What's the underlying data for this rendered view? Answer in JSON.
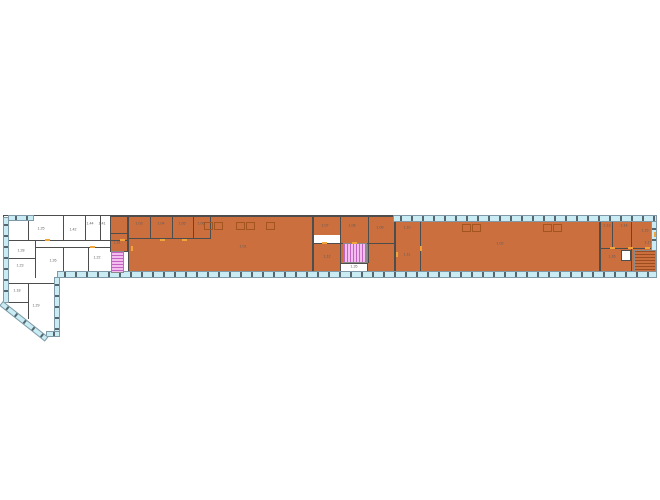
{
  "page": {
    "title": ""
  },
  "plan": {
    "colors": {
      "floor_white": "#ffffff",
      "highlight_orange": "#cb6f3e",
      "wall": "#4d4d4d",
      "outline": "#7e8487",
      "glass": "#c9ecf4",
      "glassEdge": "#7f9aa6",
      "mullion": "#55666d",
      "door": "#f0a43a",
      "desk": "#a3541f",
      "stair_pink": "#f3bdf0",
      "stair_pink_tread": "#c263c2",
      "stair_orange_tread": "#9d4c1d",
      "stairEdge": "#8b8b8b",
      "label": "#5c5c5c"
    },
    "shapes": [
      {
        "name": "building-main-strip",
        "x": 3,
        "y": 215,
        "w": 654,
        "h": 63,
        "fill": "#ffffff",
        "stroke": "#7e8487"
      },
      {
        "name": "building-left-wing",
        "x": 3,
        "y": 215,
        "w": 57,
        "h": 121,
        "fill": "#ffffff"
      },
      {
        "name": "diagonal-mask",
        "x": 1,
        "y": 302,
        "w": 72,
        "h": 48,
        "fill": "#ffffff",
        "rot": 38.3
      },
      {
        "name": "service-rooms-west",
        "x": 110,
        "y": 216,
        "w": 18,
        "h": 36,
        "fill": "#cb6f3e",
        "stroke": "#4d4d4d"
      },
      {
        "name": "open-office-west",
        "x": 128,
        "y": 216,
        "w": 185,
        "h": 57,
        "fill": "#cb6f3e",
        "stroke": "#4d4d4d"
      },
      {
        "name": "core-cluster",
        "x": 313,
        "y": 216,
        "w": 82,
        "h": 57,
        "fill": "#cb6f3e",
        "stroke": "#4d4d4d"
      },
      {
        "name": "open-office-east",
        "x": 395,
        "y": 221,
        "w": 205,
        "h": 51,
        "fill": "#cb6f3e",
        "stroke": "#4d4d4d"
      },
      {
        "name": "east-rooms",
        "x": 600,
        "y": 221,
        "w": 57,
        "h": 51,
        "fill": "#cb6f3e",
        "stroke": "#4d4d4d"
      },
      {
        "name": "corridor-notch",
        "x": 314,
        "y": 235,
        "w": 26,
        "h": 8,
        "fill": "#ffffff"
      },
      {
        "name": "stair-landing",
        "x": 340,
        "y": 263,
        "w": 28,
        "h": 10,
        "fill": "#ffffff",
        "stroke": "#4d4d4d"
      },
      {
        "name": "elevator",
        "x": 621,
        "y": 250,
        "w": 10,
        "h": 11,
        "fill": "#ffffff",
        "stroke": "#4d4d4d"
      }
    ],
    "walls": [
      {
        "x": 3,
        "y": 215,
        "w": 392,
        "h": 1
      },
      {
        "x": 3,
        "y": 215,
        "w": 1,
        "h": 88
      },
      {
        "x": 28,
        "y": 215,
        "w": 1,
        "h": 26
      },
      {
        "x": 63,
        "y": 215,
        "w": 1,
        "h": 26
      },
      {
        "x": 85,
        "y": 215,
        "w": 1,
        "h": 26
      },
      {
        "x": 100,
        "y": 215,
        "w": 1,
        "h": 26
      },
      {
        "x": 8,
        "y": 240,
        "w": 120,
        "h": 1
      },
      {
        "x": 35,
        "y": 240,
        "w": 1,
        "h": 38
      },
      {
        "x": 3,
        "y": 258,
        "w": 33,
        "h": 1
      },
      {
        "x": 35,
        "y": 247,
        "w": 75,
        "h": 1
      },
      {
        "x": 63,
        "y": 247,
        "w": 1,
        "h": 31
      },
      {
        "x": 88,
        "y": 247,
        "w": 1,
        "h": 31
      },
      {
        "x": 3,
        "y": 283,
        "w": 56,
        "h": 1
      },
      {
        "x": 28,
        "y": 283,
        "w": 1,
        "h": 36
      },
      {
        "x": 3,
        "y": 302,
        "w": 26,
        "h": 1
      },
      {
        "x": 150,
        "y": 216,
        "w": 1,
        "h": 23
      },
      {
        "x": 172,
        "y": 216,
        "w": 1,
        "h": 23
      },
      {
        "x": 193,
        "y": 216,
        "w": 1,
        "h": 23
      },
      {
        "x": 210,
        "y": 216,
        "w": 1,
        "h": 23
      },
      {
        "x": 128,
        "y": 238,
        "w": 83,
        "h": 1
      },
      {
        "x": 110,
        "y": 233,
        "w": 18,
        "h": 1
      },
      {
        "x": 340,
        "y": 216,
        "w": 1,
        "h": 57
      },
      {
        "x": 368,
        "y": 216,
        "w": 1,
        "h": 47
      },
      {
        "x": 313,
        "y": 243,
        "w": 82,
        "h": 1
      },
      {
        "x": 420,
        "y": 221,
        "w": 1,
        "h": 51
      },
      {
        "x": 612,
        "y": 221,
        "w": 1,
        "h": 28
      },
      {
        "x": 631,
        "y": 221,
        "w": 1,
        "h": 28
      },
      {
        "x": 600,
        "y": 248,
        "w": 57,
        "h": 1
      },
      {
        "x": 631,
        "y": 248,
        "w": 1,
        "h": 24
      }
    ],
    "windows": [
      {
        "name": "window-band-top",
        "x": 393,
        "y": 215,
        "w": 264,
        "h": 7,
        "dir": "h"
      },
      {
        "name": "window-band-bottom",
        "x": 57,
        "y": 271,
        "w": 600,
        "h": 7,
        "dir": "h"
      },
      {
        "name": "window-band-top-west",
        "x": 8,
        "y": 215,
        "w": 26,
        "h": 6,
        "dir": "h"
      },
      {
        "name": "window-band-west",
        "x": 3,
        "y": 217,
        "w": 6,
        "h": 86,
        "dir": "v"
      },
      {
        "name": "window-band-court",
        "x": 54,
        "y": 277,
        "w": 6,
        "h": 57,
        "dir": "v"
      },
      {
        "name": "window-band-east",
        "x": 651,
        "y": 221,
        "w": 6,
        "h": 51,
        "dir": "v"
      },
      {
        "name": "window-band-wing-bottom",
        "x": 46,
        "y": 331,
        "w": 14,
        "h": 6,
        "dir": "h"
      },
      {
        "name": "window-band-diagonal",
        "x": 3,
        "y": 301,
        "w": 58,
        "h": 6,
        "dir": "h",
        "rot": 38.3
      }
    ],
    "stairs": [
      {
        "name": "staircase-west",
        "x": 111,
        "y": 251,
        "w": 13,
        "h": 22,
        "dir": "h",
        "c1": "#f3bdf0",
        "c2": "#c263c2"
      },
      {
        "name": "staircase-central",
        "x": 343,
        "y": 243,
        "w": 24,
        "h": 20,
        "dir": "v",
        "c1": "#f3bdf0",
        "c2": "#c263c2"
      },
      {
        "name": "staircase-east",
        "x": 634,
        "y": 250,
        "w": 22,
        "h": 22,
        "dir": "h",
        "c1": "#cb6f3e",
        "c2": "#9d4c1d"
      }
    ],
    "desks": [
      {
        "x": 204,
        "y": 222,
        "w": 9,
        "h": 8
      },
      {
        "x": 214,
        "y": 222,
        "w": 9,
        "h": 8
      },
      {
        "x": 236,
        "y": 222,
        "w": 9,
        "h": 8
      },
      {
        "x": 246,
        "y": 222,
        "w": 9,
        "h": 8
      },
      {
        "x": 266,
        "y": 222,
        "w": 9,
        "h": 8
      },
      {
        "x": 462,
        "y": 224,
        "w": 9,
        "h": 8
      },
      {
        "x": 472,
        "y": 224,
        "w": 9,
        "h": 8
      },
      {
        "x": 543,
        "y": 224,
        "w": 9,
        "h": 8
      },
      {
        "x": 553,
        "y": 224,
        "w": 9,
        "h": 8
      }
    ],
    "dashes": [
      {
        "x": 120,
        "y": 239,
        "w": 5,
        "h": 2
      },
      {
        "x": 160,
        "y": 239,
        "w": 5,
        "h": 2
      },
      {
        "x": 182,
        "y": 239,
        "w": 5,
        "h": 2
      },
      {
        "x": 45,
        "y": 239,
        "w": 5,
        "h": 2
      },
      {
        "x": 90,
        "y": 246,
        "w": 5,
        "h": 2
      },
      {
        "x": 322,
        "y": 242,
        "w": 5,
        "h": 2
      },
      {
        "x": 352,
        "y": 242,
        "w": 5,
        "h": 2
      },
      {
        "x": 396,
        "y": 252,
        "w": 2,
        "h": 5
      },
      {
        "x": 420,
        "y": 246,
        "w": 2,
        "h": 5
      },
      {
        "x": 610,
        "y": 247,
        "w": 5,
        "h": 2
      },
      {
        "x": 628,
        "y": 247,
        "w": 5,
        "h": 2
      },
      {
        "x": 645,
        "y": 247,
        "w": 5,
        "h": 2
      },
      {
        "x": 654,
        "y": 232,
        "w": 2,
        "h": 5
      },
      {
        "x": 131,
        "y": 246,
        "w": 2,
        "h": 5
      }
    ],
    "labels": [
      {
        "text": "1.25",
        "x": 41,
        "y": 229
      },
      {
        "text": "1.42",
        "x": 73,
        "y": 230
      },
      {
        "text": "1.44",
        "x": 90,
        "y": 224
      },
      {
        "text": "1.41",
        "x": 102,
        "y": 224
      },
      {
        "text": "1.26",
        "x": 53,
        "y": 261
      },
      {
        "text": "1.22",
        "x": 97,
        "y": 258
      },
      {
        "text": "1.28",
        "x": 21,
        "y": 251
      },
      {
        "text": "1.23",
        "x": 20,
        "y": 266
      },
      {
        "text": "1.18",
        "x": 17,
        "y": 291
      },
      {
        "text": "1.29",
        "x": 36,
        "y": 306
      },
      {
        "text": "1.31",
        "x": 117,
        "y": 243
      },
      {
        "text": "1.03",
        "x": 139,
        "y": 224
      },
      {
        "text": "1.04",
        "x": 161,
        "y": 224
      },
      {
        "text": "1.05",
        "x": 182,
        "y": 224
      },
      {
        "text": "1.06",
        "x": 201,
        "y": 224
      },
      {
        "text": "1.01",
        "x": 243,
        "y": 247
      },
      {
        "text": "1.02",
        "x": 500,
        "y": 244
      },
      {
        "text": "1.07",
        "x": 325,
        "y": 226
      },
      {
        "text": "1.08",
        "x": 352,
        "y": 226
      },
      {
        "text": "1.09",
        "x": 380,
        "y": 228
      },
      {
        "text": "1.10",
        "x": 407,
        "y": 228
      },
      {
        "text": "1.11",
        "x": 407,
        "y": 255
      },
      {
        "text": "1.12",
        "x": 327,
        "y": 257
      },
      {
        "text": "1.35",
        "x": 354,
        "y": 267
      },
      {
        "text": "1.13",
        "x": 607,
        "y": 226
      },
      {
        "text": "1.14",
        "x": 624,
        "y": 226
      },
      {
        "text": "1.15",
        "x": 645,
        "y": 231
      },
      {
        "text": "1.16",
        "x": 612,
        "y": 257
      },
      {
        "text": "1.17",
        "x": 648,
        "y": 243
      }
    ]
  }
}
